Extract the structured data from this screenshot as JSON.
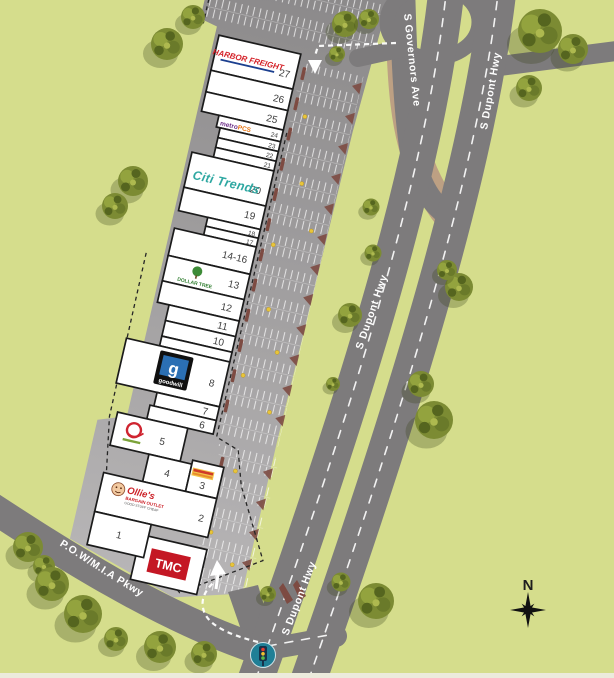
{
  "roads": {
    "dupont_hwy": "S Dupont Hwy",
    "governors_ave": "S Governors Ave",
    "pow_mia_pkwy": "P.O.W/M.I.A Pkwy"
  },
  "compass_north": "N",
  "site": {
    "units": {
      "u27": "27",
      "u26": "26",
      "u25": "25",
      "u24": "24",
      "u23": "23",
      "u22": "22",
      "u21": "21",
      "u20": "20",
      "u19": "19",
      "u18": "18",
      "u17": "17",
      "u14_16": "14-16",
      "u13": "13",
      "u12": "12",
      "u11": "11",
      "u10": "10",
      "u9": "9",
      "u8": "8",
      "u7": "7",
      "u6": "6",
      "u5": "5",
      "u4": "4",
      "u3": "3",
      "u2": "2",
      "u1": "1"
    },
    "tenants": {
      "harbor_freight": "HARBOR FREIGHT",
      "metro": "metro",
      "metro_pcs": "PCS",
      "citi_trends": "Citi Trends",
      "dollar_tree": "DOLLAR TREE",
      "goodwill_g": "g",
      "goodwill": "goodwill",
      "ollies_script": "Ollie's",
      "ollies_sub": "BARGAIN OUTLET",
      "ollies_tag": "GOOD STUFF CHEAP",
      "tmc": "TMC"
    },
    "colors": {
      "background_green": "#d5dd8c",
      "road_gray": "#7d7b7c",
      "lot_gray_dark": "#8a8889",
      "lot_gray_light": "#b8b6b7",
      "island_maroon": "#7d4b42",
      "light_pole_yellow": "#e8c53a",
      "available_unit_green": "#9aa743",
      "harbor_freight_red": "#d42027",
      "harbor_freight_blue": "#1b3f8f",
      "metro_purple": "#6b2d87",
      "metro_pcs_orange": "#e87511",
      "citi_trends_teal": "#2fa8a2",
      "dollar_tree_green": "#2f7d2f",
      "goodwill_blue": "#2b6fb3",
      "ollies_red": "#cc2229",
      "tmc_red": "#c41724",
      "signal_circle_teal": "#1f7f96"
    }
  }
}
